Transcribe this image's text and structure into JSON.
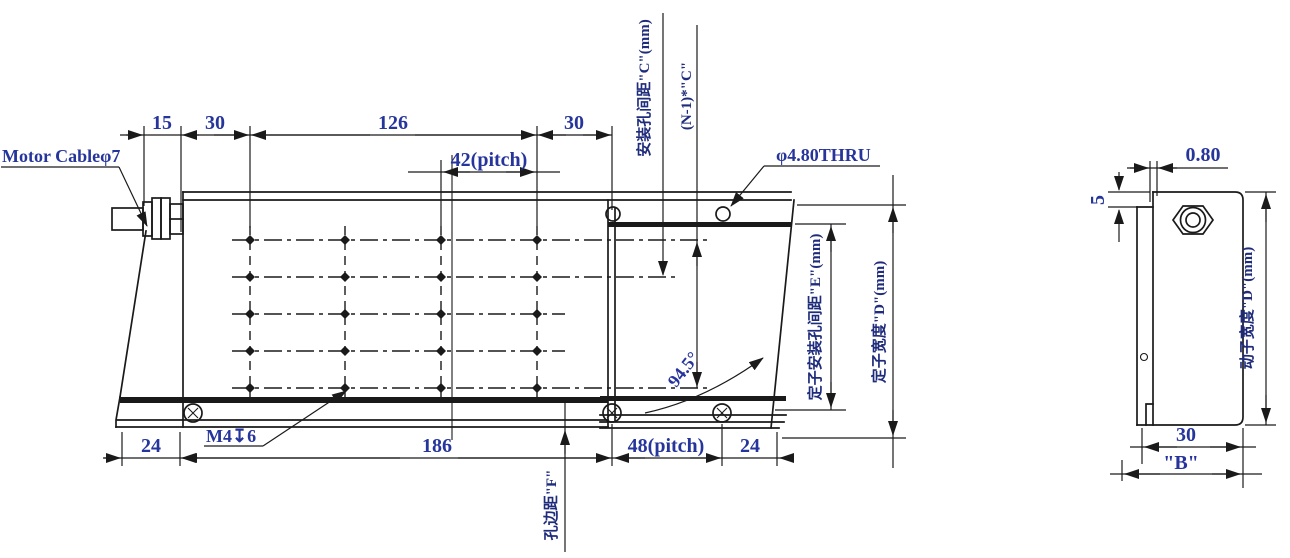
{
  "drawing": {
    "main_view": {
      "motor_cable_label": "Motor Cableφ7",
      "dim_15": "15",
      "dim_30_left": "30",
      "dim_126": "126",
      "dim_30_right": "30",
      "dim_42_pitch": "42(pitch)",
      "hole_spacing_c_label": "安装孔间距\"C\"(mm)",
      "total_spacing_label": "(N-1)*\"C\"",
      "thru_hole_label": "φ4.80THRU",
      "angle_label": "94.5°",
      "thread_label": "M4↧6",
      "dim_24_left": "24",
      "dim_186": "186",
      "dim_48_pitch": "48(pitch)",
      "dim_24_right": "24",
      "hole_edge_label": "孔边距\"F\"",
      "stator_hole_spacing_label": "定子安装孔间距\"E\"(mm)",
      "stator_width_label": "定子宽度\"D\"(mm)"
    },
    "side_view": {
      "dim_080": "0.80",
      "dim_5": "5",
      "dim_30": "30",
      "dim_b": "\"B\"",
      "mover_width_label": "动子宽度\"D\"(mm)"
    },
    "colors": {
      "dimension_text": "#26359b",
      "chinese_text": "#1f2c7c",
      "line_color": "#1a1a1a",
      "background": "#ffffff"
    }
  }
}
